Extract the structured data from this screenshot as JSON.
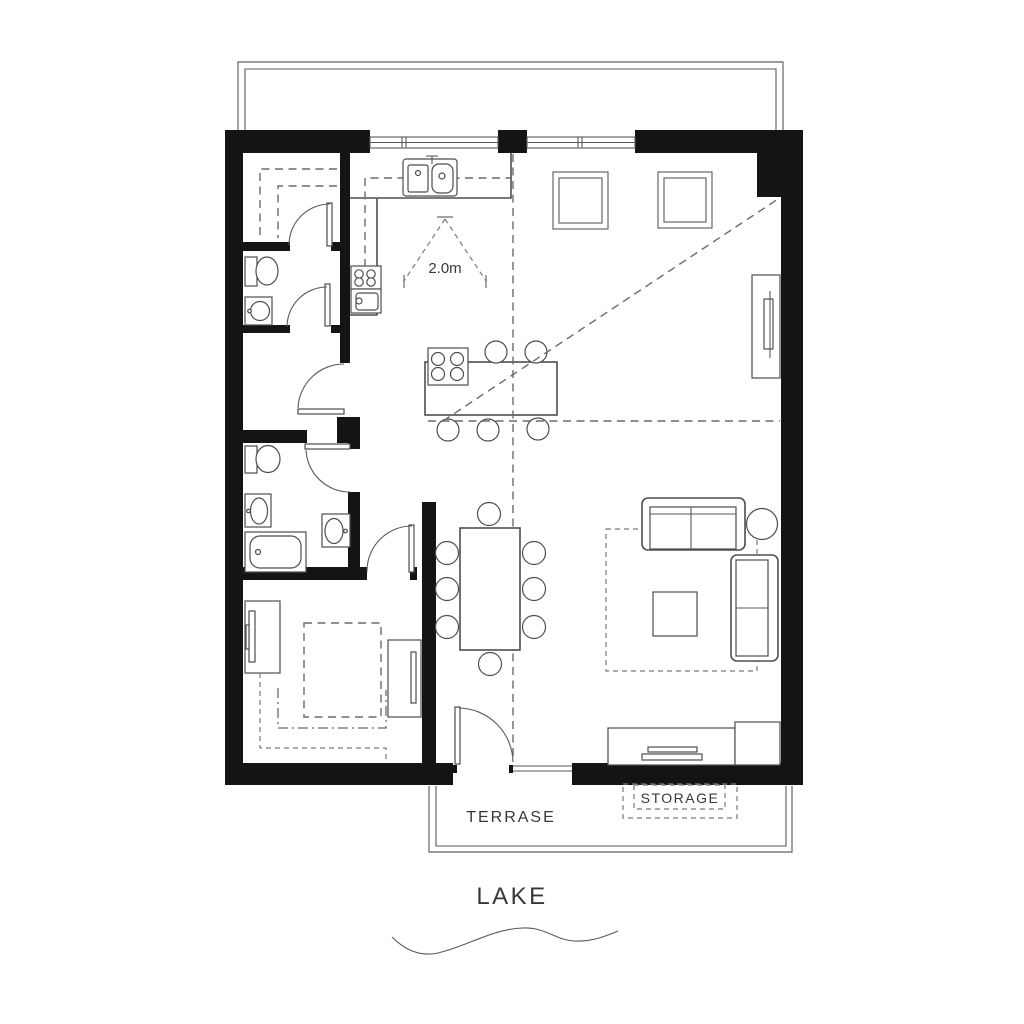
{
  "labels": {
    "dimension": "2.0m",
    "terrace": "TERRASE",
    "storage": "STORAGE",
    "lake": "LAKE"
  },
  "colors": {
    "background": "#ffffff",
    "wall": "#141414",
    "line": "#4e4e4e",
    "dashed_line": "#6b6b6b",
    "balcony_line": "#7a7a7a",
    "text": "#383838"
  }
}
